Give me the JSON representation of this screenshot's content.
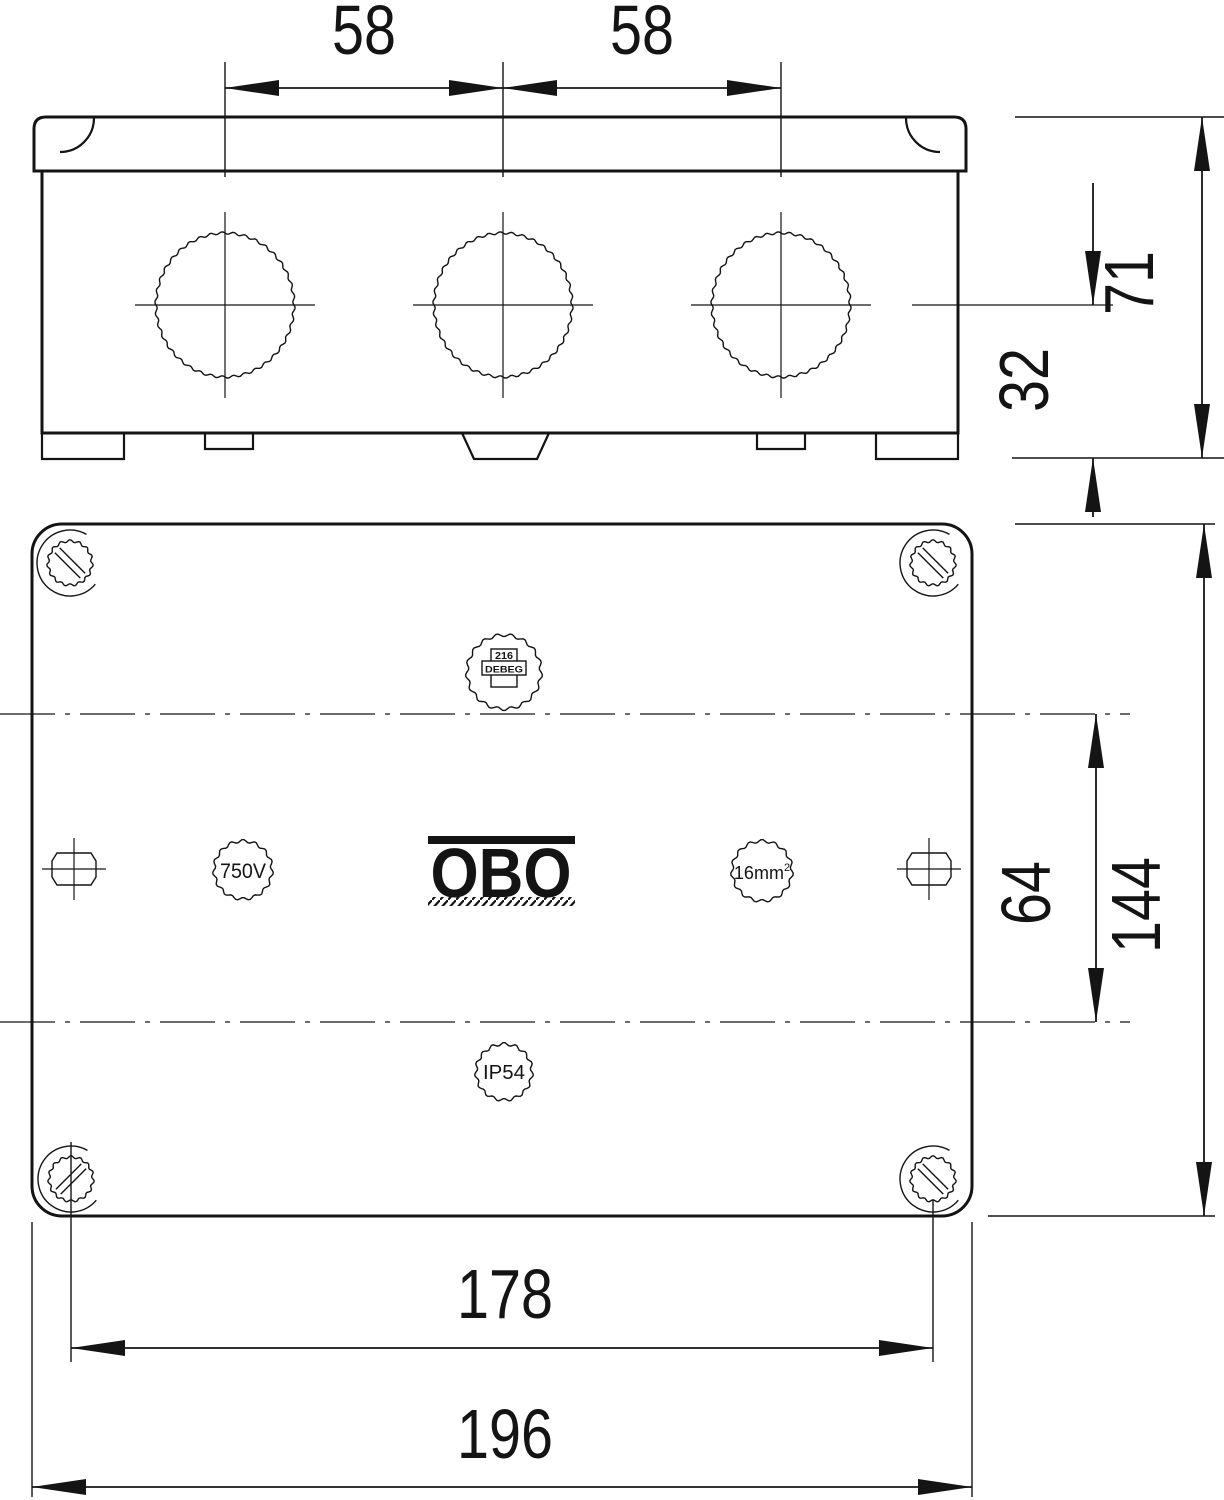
{
  "colors": {
    "ink": "#141414",
    "background": "#ffffff"
  },
  "top_view": {
    "description": "side elevation of box with lid and three knockouts",
    "dim_span_left": "58",
    "dim_span_right": "58",
    "dim_height_total": "71",
    "dim_height_lower": "32"
  },
  "plan_view": {
    "description": "plan view of lid with four cover screws",
    "dim_screw_spacing": "178",
    "dim_width_outer": "196",
    "dim_height_outer": "144",
    "dim_centerline_spacing": "64",
    "stamps": {
      "voltage": "750V",
      "conductor": "16mm",
      "conductor_exponent": "2",
      "protection": "IP54",
      "logo": "OBO",
      "badge_line1": "216",
      "badge_line2": "DEBEG"
    }
  }
}
